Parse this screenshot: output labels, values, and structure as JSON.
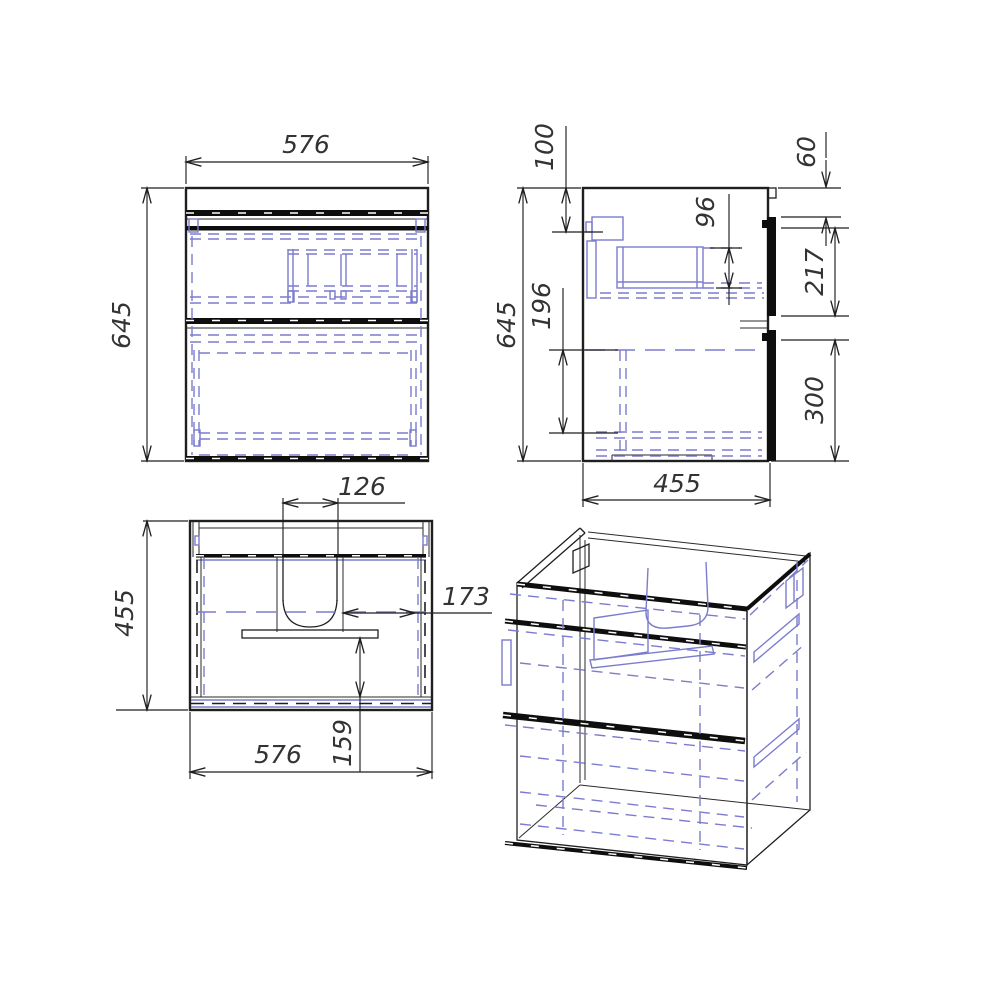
{
  "style": {
    "background": "#ffffff",
    "line_color": "#1f1f1f",
    "hidden_line_color": "#7c7cce"
  },
  "views": {
    "front": {
      "label": "front-view",
      "width": "576",
      "height": "645"
    },
    "side": {
      "label": "side-view",
      "height": "645",
      "depth": "455",
      "top_offset": "100",
      "top_gap": "60",
      "drawer_box_height": "96",
      "upper_front_height": "217",
      "lower_box_height": "196",
      "lower_front_height": "300"
    },
    "plan": {
      "label": "top-view",
      "depth": "455",
      "width": "576",
      "cutout_width": "126",
      "cutout_to_side": "173",
      "bracket_to_back": "159"
    },
    "iso": {
      "label": "isometric-view"
    }
  }
}
